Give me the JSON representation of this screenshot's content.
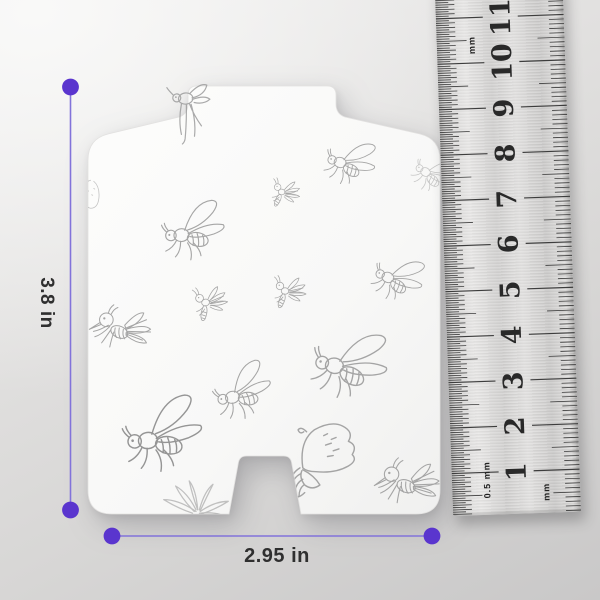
{
  "dimensions": {
    "height_label": "3.8 in",
    "width_label": "2.95 in"
  },
  "ruler": {
    "numbers": [
      1,
      2,
      3,
      4,
      5,
      6,
      7,
      8,
      9,
      10,
      11
    ],
    "unit_top_label": "mm",
    "unit_bottom_left_label": "0.5 mm",
    "unit_bottom_right_label": "mm",
    "cm_spacing_px": 45.5,
    "zero_y_px": 535
  },
  "colors": {
    "accent_purple": "#5a35ce",
    "dim_line": "#8273da",
    "label_text": "#2f2f2f",
    "sketch_stroke": "#9c9c9c",
    "card_fill": "#fbfbfa",
    "ruler_metal": "#d6d5d4"
  },
  "flies": [
    {
      "type": "flylegs",
      "x": 196,
      "y": 120,
      "scale": 0.8,
      "rot": -6,
      "unclipped": true,
      "opacity": 0.85
    },
    {
      "type": "fly",
      "x": 350,
      "y": 160,
      "scale": 0.6,
      "rot": 14
    },
    {
      "type": "bee",
      "x": 284,
      "y": 194,
      "scale": 0.44,
      "rot": 6
    },
    {
      "type": "fly",
      "x": 192,
      "y": 228,
      "scale": 0.75,
      "rot": -6
    },
    {
      "type": "bee",
      "x": 288,
      "y": 293,
      "scale": 0.5,
      "rot": 0
    },
    {
      "type": "fly",
      "x": 398,
      "y": 276,
      "scale": 0.6,
      "rot": 20
    },
    {
      "type": "mosq",
      "x": 122,
      "y": 332,
      "scale": 0.68,
      "rot": 0
    },
    {
      "type": "bee",
      "x": 209,
      "y": 304,
      "scale": 0.52,
      "rot": -10
    },
    {
      "type": "fly",
      "x": 349,
      "y": 361,
      "scale": 0.9,
      "rot": 10
    },
    {
      "type": "fly",
      "x": 241,
      "y": 389,
      "scale": 0.7,
      "rot": -16
    },
    {
      "type": "fly",
      "x": 161,
      "y": 431,
      "scale": 0.95,
      "rot": -8,
      "color": "#8a8a8a"
    },
    {
      "type": "moth",
      "x": 318,
      "y": 466,
      "scale": 0.95,
      "rot": 0
    },
    {
      "type": "mosq",
      "x": 409,
      "y": 486,
      "scale": 0.72,
      "rot": -4
    },
    {
      "type": "flower",
      "x": 196,
      "y": 503,
      "scale": 0.85,
      "rot": 0,
      "opacity": 0.6
    },
    {
      "type": "scribble",
      "x": 101,
      "y": 201,
      "scale": 0.52,
      "rot": 0,
      "opacity": 0.6
    },
    {
      "type": "fly",
      "x": 434,
      "y": 172,
      "scale": 0.5,
      "rot": 28,
      "opacity": 0.55
    }
  ]
}
